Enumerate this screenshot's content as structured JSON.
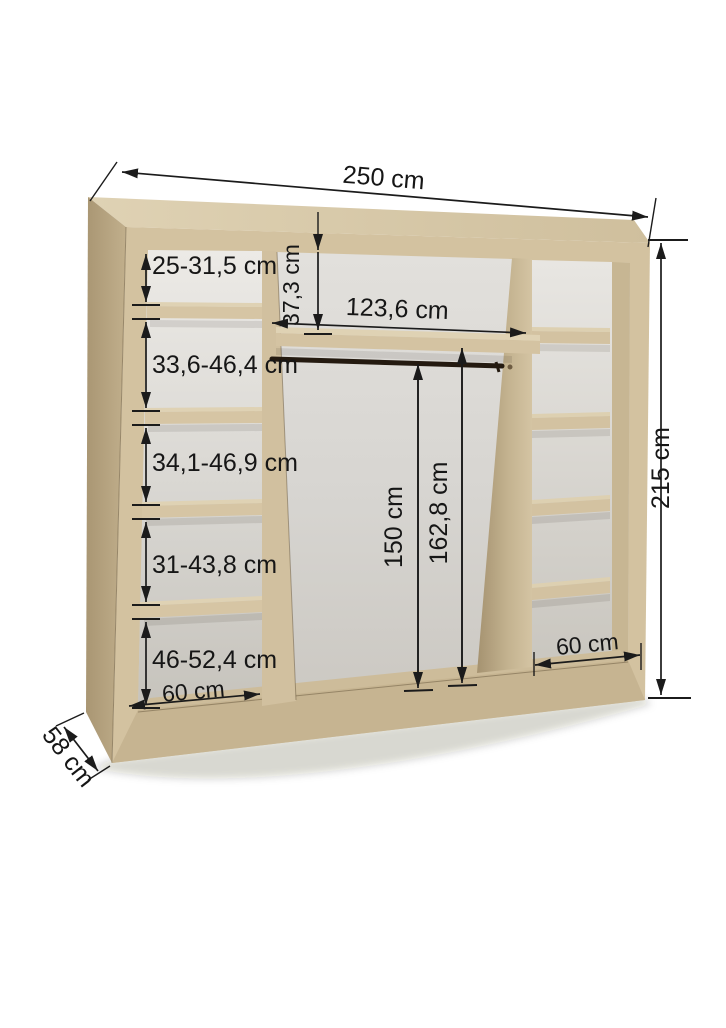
{
  "diagram": {
    "kind": "wardrobe-dimension-diagram",
    "unit": "cm",
    "overall": {
      "width_label": "250 cm",
      "height_label": "215 cm",
      "depth_label": "58 cm"
    },
    "left_column": {
      "width_label": "60 cm",
      "shelf_gap_labels": [
        "25-31,5 cm",
        "33,6-46,4 cm",
        "34,1-46,9 cm",
        "31-43,8 cm",
        "46-52,4 cm"
      ]
    },
    "middle_section": {
      "width_label": "123,6 cm",
      "top_shelf_gap_label": "37,3 cm",
      "rail_height_label": "150 cm",
      "interior_height_label": "162,8 cm"
    },
    "right_column": {
      "width_label": "60 cm"
    },
    "colors": {
      "wood_front": "#d3c2a0",
      "wood_top": "#d9cbab",
      "wood_side": "#b4a27f",
      "back_panel": "#dad8d3",
      "dimension_line": "#1b1b1b",
      "background": "#ffffff"
    }
  }
}
